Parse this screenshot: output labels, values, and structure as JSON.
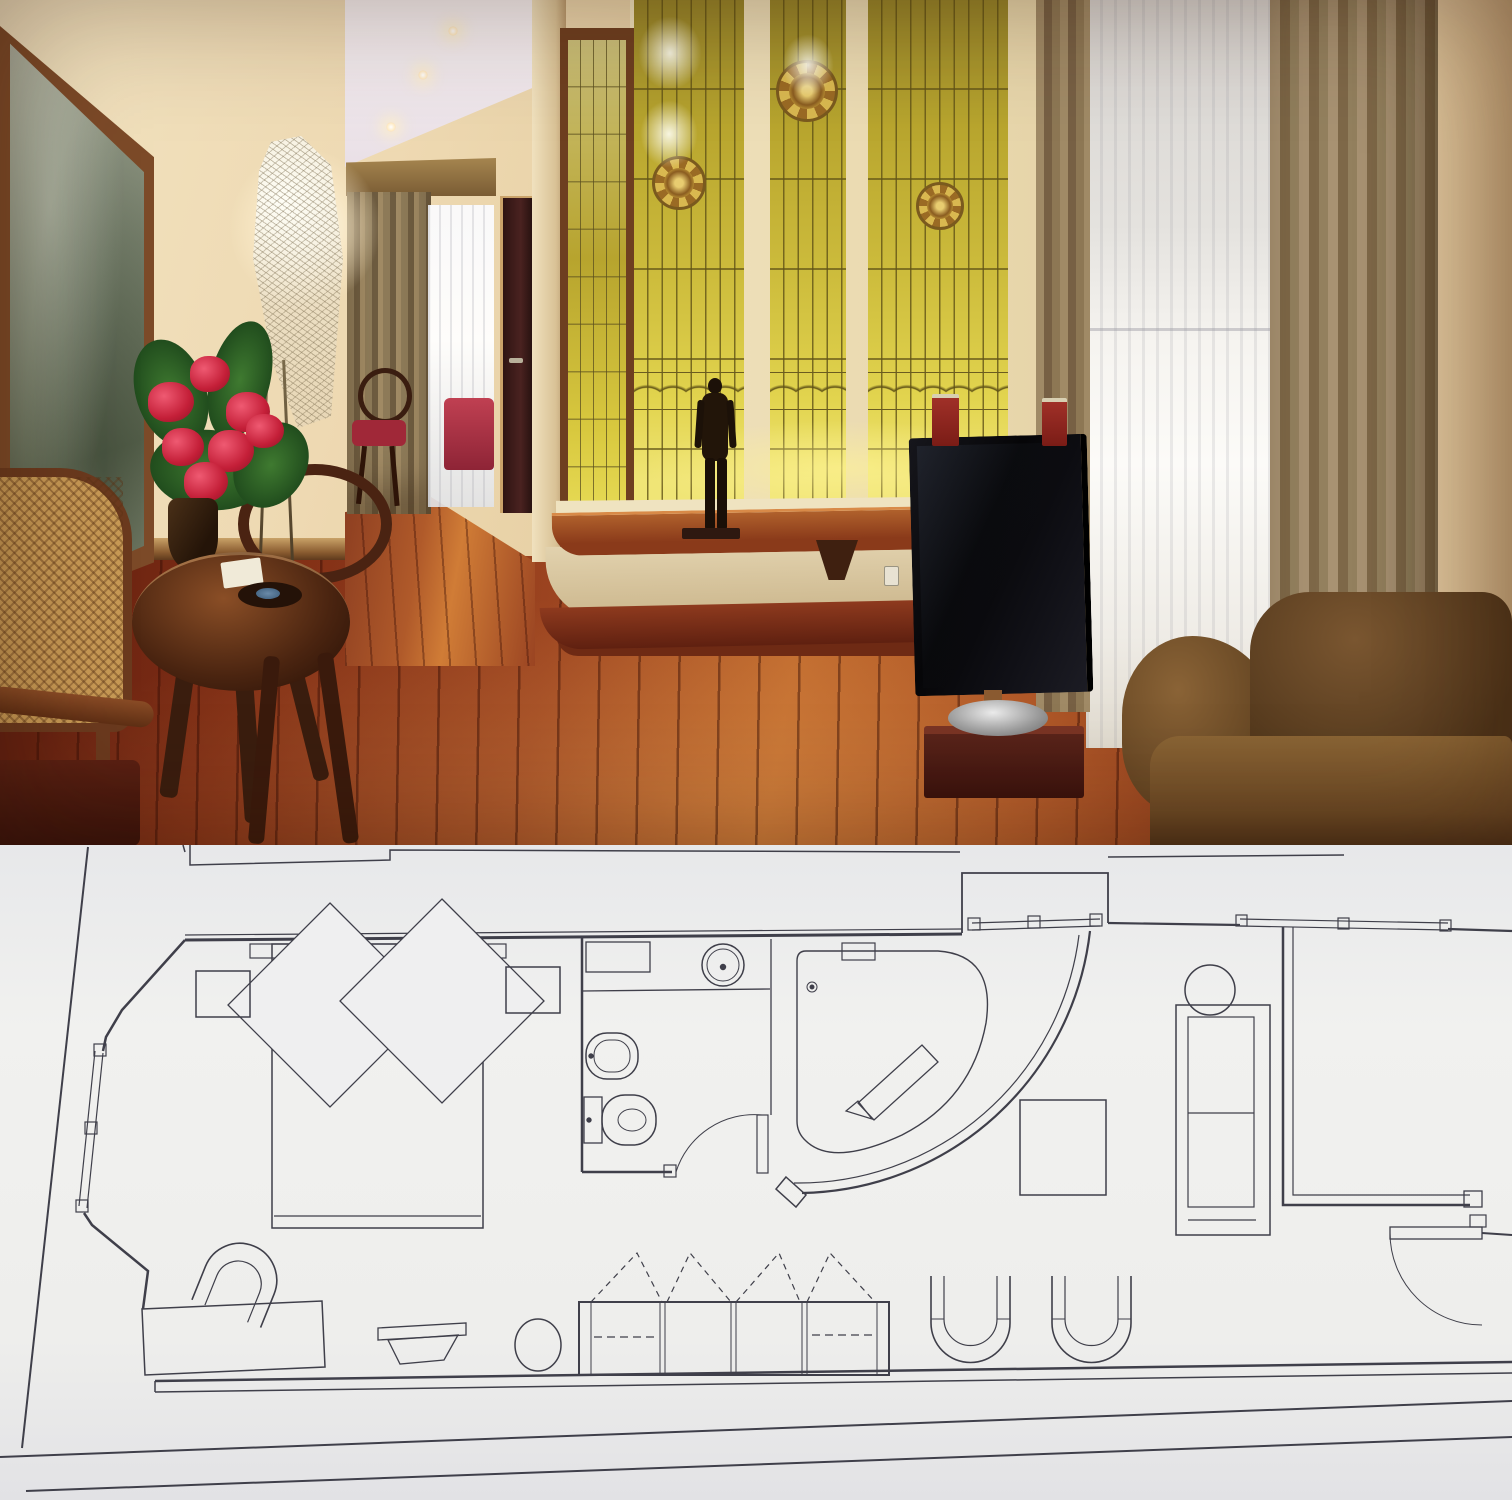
{
  "meta": {
    "subject": "hotel-suite-photo-over-floor-plan"
  },
  "palette": {
    "wall": "#eed9b2",
    "wallShade": "#d2b286",
    "ceiling": "#f7f1f2",
    "glassTop": "#97852a",
    "glassMid": "#cdbc3c",
    "glassGlow": "#f0e576",
    "lead": "#6b5c20",
    "mullion": "#f0e2bd",
    "frameWood": "#7c4a28",
    "canvas": "#79826e",
    "drape": "#8d7a58",
    "drapeRight": "#a89272",
    "sheer": "#f6f4f0",
    "doorDark": "#4a2220",
    "floorDeep": "#5f1f10",
    "floorHot": "#c06a2e",
    "hallFloor": "#b05a2a",
    "ledgeWood": "#8a3a1a",
    "ledgeFace": "#e2d2ae",
    "ledgeBase": "#8e3a1e",
    "tvBlack": "#0a0a0e",
    "tvBase": "#3a120c",
    "silver": "#9a9a9a",
    "bookRed": "#8c2220",
    "sofaBrown": "#6a4824",
    "statue": "#1c1108",
    "leaf": "#2d5a26",
    "flower": "#c41f38",
    "tableWood": "#4a2410",
    "cane": "#c89a55",
    "bedRed": "#a02838",
    "paper": "#efeff0",
    "planInk": "#3f3f4a"
  },
  "scene": {
    "objects": [
      "framed-painting",
      "mesh-floor-lamp",
      "hallway",
      "hall-curtain",
      "hall-sheer-window",
      "hall-chair",
      "hall-bed",
      "hall-door",
      "stained-glass-bay",
      "rosette-medallions",
      "bronze-statue",
      "curved-wood-ledge",
      "flat-tv",
      "tv-pedestal",
      "red-books",
      "sheer-window",
      "drapes",
      "velvet-sofa",
      "round-table",
      "flower-bouquet",
      "cane-armchair",
      "wood-armchair",
      "parquet-floor"
    ]
  },
  "floor_plan": {
    "viewBox": "0 0 1512 655",
    "bg": "#efeff0",
    "stroke": "#3f3f4a",
    "shapes": [
      {
        "t": "line",
        "n": "context-left-slant",
        "x1": 88,
        "y1": 2,
        "x2": 22,
        "y2": 603,
        "sw": 2
      },
      {
        "t": "line",
        "n": "context-top-tick",
        "x1": 183,
        "y1": 0,
        "x2": 185,
        "y2": 7,
        "sw": 1.5
      },
      {
        "t": "polyline",
        "n": "context-top-left",
        "pts": "190,0 190,20 390,15 390,5 960,7",
        "sw": 1.5
      },
      {
        "t": "polyline",
        "n": "bay-outline",
        "pts": "962,88 962,28 1108,28 1108,78",
        "sw": 1.8
      },
      {
        "t": "line",
        "n": "context-top-right",
        "x1": 1108,
        "y1": 12,
        "x2": 1344,
        "y2": 10,
        "sw": 1.5
      },
      {
        "t": "line",
        "n": "page-edge-1",
        "x1": 0,
        "y1": 612,
        "x2": 1512,
        "y2": 556,
        "sw": 2
      },
      {
        "t": "line",
        "n": "page-edge-2",
        "x1": 26,
        "y1": 646,
        "x2": 1512,
        "y2": 592,
        "sw": 2
      },
      {
        "t": "line",
        "n": "wall-top-a",
        "x1": 185,
        "y1": 90,
        "x2": 962,
        "y2": 84,
        "sw": 1.2
      },
      {
        "t": "line",
        "n": "wall-top-b",
        "x1": 185,
        "y1": 95,
        "x2": 962,
        "y2": 89,
        "sw": 3
      },
      {
        "t": "polyline",
        "n": "wall-left-upper",
        "pts": "185,95 122,165 106,192 103,206",
        "sw": 2.5
      },
      {
        "t": "line",
        "n": "window-left-a",
        "x1": 103,
        "y1": 208,
        "x2": 87,
        "y2": 363,
        "sw": 1.2
      },
      {
        "t": "line",
        "n": "window-left-b",
        "x1": 95,
        "y1": 206,
        "x2": 79,
        "y2": 361,
        "sw": 1.2
      },
      {
        "t": "rect",
        "n": "window-left-jamb-1",
        "x": 94,
        "y": 199,
        "w": 12,
        "h": 12,
        "sw": 1.2
      },
      {
        "t": "rect",
        "n": "window-left-jamb-2",
        "x": 85,
        "y": 277,
        "w": 12,
        "h": 12,
        "sw": 1.2
      },
      {
        "t": "rect",
        "n": "window-left-jamb-3",
        "x": 76,
        "y": 355,
        "w": 12,
        "h": 12,
        "sw": 1.2
      },
      {
        "t": "polyline",
        "n": "wall-left-lower",
        "pts": "84,368 92,380 148,426 143,464",
        "sw": 2.5
      },
      {
        "t": "line",
        "n": "wall-bottom-a",
        "x1": 155,
        "y1": 536,
        "x2": 1512,
        "y2": 517,
        "sw": 2.5
      },
      {
        "t": "line",
        "n": "wall-bottom-b",
        "x1": 155,
        "y1": 547,
        "x2": 1512,
        "y2": 528,
        "sw": 1.5
      },
      {
        "t": "line",
        "n": "wall-bottom-cap",
        "x1": 155,
        "y1": 536,
        "x2": 155,
        "y2": 547,
        "sw": 1.5
      },
      {
        "t": "rect",
        "n": "headboard",
        "x": 250,
        "y": 99,
        "w": 256,
        "h": 14,
        "sw": 1.2
      },
      {
        "t": "rect",
        "n": "bed",
        "x": 272,
        "y": 99,
        "w": 211,
        "h": 284,
        "sw": 1.5
      },
      {
        "t": "line",
        "n": "bed-foot-line",
        "x1": 274,
        "y1": 371,
        "x2": 481,
        "y2": 371,
        "sw": 1.2
      },
      {
        "t": "polygon",
        "n": "pillow-left",
        "pts": "330,58 432,160 330,262 228,160",
        "sw": 1.3,
        "f": "bg"
      },
      {
        "t": "polygon",
        "n": "pillow-right",
        "pts": "442,54 544,156 442,258 340,156",
        "sw": 1.3,
        "f": "bg"
      },
      {
        "t": "rect",
        "n": "nightstand-left",
        "x": 196,
        "y": 126,
        "w": 54,
        "h": 46,
        "sw": 1.5
      },
      {
        "t": "rect",
        "n": "nightstand-right",
        "x": 506,
        "y": 122,
        "w": 54,
        "h": 46,
        "sw": 1.5
      },
      {
        "t": "path",
        "n": "armchair",
        "d": "M 196,470 L 196,434 A 37 37 0 0 1 270,434 L 270,470",
        "sw": 1.6,
        "tr": "rotate(22 233 452)"
      },
      {
        "t": "path",
        "n": "armchair-inner",
        "d": "M 210,470 L 210,438 A 23 23 0 0 1 256,438 L 256,470",
        "sw": 1.2,
        "tr": "rotate(22 233 452)"
      },
      {
        "t": "polygon",
        "n": "console-table",
        "pts": "142,464 322,456 325,522 145,530",
        "sw": 1.5
      },
      {
        "t": "polygon",
        "n": "tray-lip",
        "pts": "378,483 466,478 466,490 378,495",
        "sw": 1.3
      },
      {
        "t": "polygon",
        "n": "tray-body",
        "pts": "388,495 458,490 444,515 400,519",
        "sw": 1.3
      },
      {
        "t": "ellipse",
        "n": "stool",
        "cx": 538,
        "cy": 500,
        "rx": 23,
        "ry": 26,
        "sw": 1.5
      },
      {
        "t": "line",
        "n": "bathroom-wall-left",
        "x1": 582,
        "y1": 92,
        "x2": 582,
        "y2": 327,
        "sw": 2.5
      },
      {
        "t": "line",
        "n": "bathroom-wall-bottom",
        "x1": 582,
        "y1": 327,
        "x2": 672,
        "y2": 327,
        "sw": 2.5
      },
      {
        "t": "rect",
        "n": "bath-cabinet",
        "x": 586,
        "y": 97,
        "w": 64,
        "h": 30,
        "sw": 1.3
      },
      {
        "t": "line",
        "n": "vanity-counter",
        "x1": 582,
        "y1": 146,
        "x2": 770,
        "y2": 144,
        "sw": 1.3
      },
      {
        "t": "circle",
        "n": "sink",
        "cx": 723,
        "cy": 120,
        "r": 21,
        "sw": 1.5
      },
      {
        "t": "circle",
        "n": "sink-inner",
        "cx": 723,
        "cy": 120,
        "r": 16,
        "sw": 1
      },
      {
        "t": "circle",
        "n": "sink-drain",
        "cx": 723,
        "cy": 122,
        "r": 2.5,
        "f": "ink"
      },
      {
        "t": "rect",
        "n": "bidet",
        "x": 586,
        "y": 188,
        "w": 52,
        "h": 46,
        "rx": 21,
        "sw": 1.5
      },
      {
        "t": "rect",
        "n": "bidet-inner",
        "x": 594,
        "y": 195,
        "w": 36,
        "h": 32,
        "rx": 15,
        "sw": 1
      },
      {
        "t": "circle",
        "n": "bidet-tap",
        "cx": 591,
        "cy": 211,
        "r": 2,
        "f": "ink"
      },
      {
        "t": "rect",
        "n": "toilet-tank",
        "x": 584,
        "y": 252,
        "w": 18,
        "h": 46,
        "sw": 1.3
      },
      {
        "t": "rect",
        "n": "toilet",
        "x": 602,
        "y": 250,
        "w": 54,
        "h": 50,
        "rx": 23,
        "sw": 1.5
      },
      {
        "t": "ellipse",
        "n": "toilet-seat",
        "cx": 632,
        "cy": 275,
        "rx": 14,
        "ry": 11,
        "sw": 1
      },
      {
        "t": "circle",
        "n": "toilet-tap",
        "cx": 589,
        "cy": 275,
        "r": 2,
        "f": "ink"
      },
      {
        "t": "rect",
        "n": "bath-door-jamb",
        "x": 664,
        "y": 320,
        "w": 12,
        "h": 12,
        "sw": 1.2
      },
      {
        "t": "rect",
        "n": "bath-door-leaf",
        "x": 757,
        "y": 270,
        "w": 11,
        "h": 58,
        "sw": 1.2
      },
      {
        "t": "path",
        "n": "bath-door-swing",
        "d": "M 676,327 A 82 82 0 0 1 762,270",
        "sw": 1
      },
      {
        "t": "line",
        "n": "tub-edge",
        "x1": 771,
        "y1": 94,
        "x2": 771,
        "y2": 270,
        "sw": 1.3
      },
      {
        "t": "path",
        "n": "bathtub",
        "d": "M 806,106 L 938,106 Q 996,110 986,178 Q 972,254 902,290 Q 833,322 806,296 Q 797,288 797,276 L 797,116 Q 797,106 806,106 Z",
        "sw": 1.4
      },
      {
        "t": "rect",
        "n": "tub-shelf",
        "x": 842,
        "y": 98,
        "w": 33,
        "h": 17,
        "sw": 1.2
      },
      {
        "t": "circle",
        "n": "tub-drain",
        "cx": 812,
        "cy": 142,
        "r": 5,
        "sw": 1
      },
      {
        "t": "circle",
        "n": "tub-drain-dot",
        "cx": 812,
        "cy": 142,
        "r": 1.8,
        "f": "ink"
      },
      {
        "t": "polygon",
        "n": "tub-bench",
        "pts": "858,258 922,200 938,217 874,275",
        "sw": 1.3
      },
      {
        "t": "polygon",
        "n": "tub-bench-end",
        "pts": "846,266 858,256 872,274",
        "sw": 1.2
      },
      {
        "t": "path",
        "n": "curved-wall-outer",
        "d": "M 1090,86 A 295 295 0 0 1 802,348",
        "sw": 2.2
      },
      {
        "t": "path",
        "n": "curved-wall-inner",
        "d": "M 1079,90 A 283 283 0 0 1 794,338",
        "sw": 1.2
      },
      {
        "t": "polygon",
        "n": "curved-wall-cap",
        "pts": "786,332 806,350 796,362 776,344",
        "sw": 1.5
      },
      {
        "t": "line",
        "n": "bay-window-a",
        "x1": 972,
        "y1": 78,
        "x2": 1100,
        "y2": 74,
        "sw": 1.2
      },
      {
        "t": "line",
        "n": "bay-window-b",
        "x1": 972,
        "y1": 85,
        "x2": 1100,
        "y2": 81,
        "sw": 1.2
      },
      {
        "t": "rect",
        "n": "bay-window-jamb-1",
        "x": 968,
        "y": 73,
        "w": 12,
        "h": 12,
        "sw": 1.2
      },
      {
        "t": "rect",
        "n": "bay-window-jamb-2",
        "x": 1028,
        "y": 71,
        "w": 12,
        "h": 12,
        "sw": 1.2
      },
      {
        "t": "rect",
        "n": "bay-window-jamb-3",
        "x": 1090,
        "y": 69,
        "w": 12,
        "h": 12,
        "sw": 1.2
      },
      {
        "t": "line",
        "n": "wall-top-right-a",
        "x1": 1108,
        "y1": 78,
        "x2": 1240,
        "y2": 80,
        "sw": 2.2
      },
      {
        "t": "line",
        "n": "corridor-window-a",
        "x1": 1240,
        "y1": 74,
        "x2": 1448,
        "y2": 78,
        "sw": 1.2
      },
      {
        "t": "line",
        "n": "corridor-window-b",
        "x1": 1240,
        "y1": 81,
        "x2": 1448,
        "y2": 85,
        "sw": 1.2
      },
      {
        "t": "rect",
        "n": "corridor-window-jamb-1",
        "x": 1236,
        "y": 70,
        "w": 11,
        "h": 11,
        "sw": 1.2
      },
      {
        "t": "rect",
        "n": "corridor-window-jamb-2",
        "x": 1338,
        "y": 73,
        "w": 11,
        "h": 11,
        "sw": 1.2
      },
      {
        "t": "rect",
        "n": "corridor-window-jamb-3",
        "x": 1440,
        "y": 75,
        "w": 11,
        "h": 11,
        "sw": 1.2
      },
      {
        "t": "line",
        "n": "wall-top-right-b",
        "x1": 1448,
        "y1": 84,
        "x2": 1512,
        "y2": 86,
        "sw": 2.2
      },
      {
        "t": "polyline",
        "n": "corridor-wall-outer",
        "pts": "1283,82 1283,360 1470,360",
        "sw": 2.5
      },
      {
        "t": "polyline",
        "n": "corridor-wall-inner",
        "pts": "1293,82 1293,350 1470,350",
        "sw": 1.2
      },
      {
        "t": "rect",
        "n": "entry-jamb-a",
        "x": 1464,
        "y": 346,
        "w": 18,
        "h": 16,
        "sw": 1.3
      },
      {
        "t": "rect",
        "n": "entry-jamb-b",
        "x": 1470,
        "y": 370,
        "w": 16,
        "h": 12,
        "sw": 1.2
      },
      {
        "t": "rect",
        "n": "entry-door-leaf",
        "x": 1390,
        "y": 382,
        "w": 92,
        "h": 12,
        "sw": 1.3
      },
      {
        "t": "path",
        "n": "entry-door-swing",
        "d": "M 1390,388 A 92 92 0 0 0 1482,480",
        "sw": 1
      },
      {
        "t": "line",
        "n": "entry-wall-stub",
        "x1": 1482,
        "y1": 388,
        "x2": 1512,
        "y2": 390,
        "sw": 2
      },
      {
        "t": "circle",
        "n": "side-table",
        "cx": 1210,
        "cy": 145,
        "r": 25,
        "sw": 1.5
      },
      {
        "t": "rect",
        "n": "sofa",
        "x": 1176,
        "y": 160,
        "w": 94,
        "h": 230,
        "sw": 1.5
      },
      {
        "t": "rect",
        "n": "sofa-inner",
        "x": 1188,
        "y": 172,
        "w": 66,
        "h": 190,
        "sw": 1.2
      },
      {
        "t": "line",
        "n": "sofa-cushion-line",
        "x1": 1188,
        "y1": 268,
        "x2": 1254,
        "y2": 268,
        "sw": 1.2
      },
      {
        "t": "line",
        "n": "sofa-base-line",
        "x1": 1188,
        "y1": 375,
        "x2": 1256,
        "y2": 375,
        "sw": 1.2
      },
      {
        "t": "rect",
        "n": "tv-cabinet",
        "x": 1020,
        "y": 255,
        "w": 86,
        "h": 95,
        "sw": 1.5
      },
      {
        "t": "rect",
        "n": "wardrobe",
        "x": 579,
        "y": 457,
        "w": 310,
        "h": 73,
        "sw": 2
      },
      {
        "t": "rect",
        "n": "wardrobe-cap-left",
        "x": 579,
        "y": 457,
        "w": 12,
        "h": 73,
        "sw": 1
      },
      {
        "t": "rect",
        "n": "wardrobe-cap-right",
        "x": 877,
        "y": 457,
        "w": 12,
        "h": 73,
        "sw": 1
      },
      {
        "t": "line",
        "n": "wardrobe-div-1a",
        "x1": 660,
        "y1": 457,
        "x2": 660,
        "y2": 530,
        "sw": 1
      },
      {
        "t": "line",
        "n": "wardrobe-div-1b",
        "x1": 665,
        "y1": 457,
        "x2": 665,
        "y2": 530,
        "sw": 1
      },
      {
        "t": "line",
        "n": "wardrobe-div-2a",
        "x1": 731,
        "y1": 457,
        "x2": 731,
        "y2": 530,
        "sw": 1
      },
      {
        "t": "line",
        "n": "wardrobe-div-2b",
        "x1": 736,
        "y1": 457,
        "x2": 736,
        "y2": 530,
        "sw": 1
      },
      {
        "t": "line",
        "n": "wardrobe-div-3a",
        "x1": 802,
        "y1": 457,
        "x2": 802,
        "y2": 530,
        "sw": 1
      },
      {
        "t": "line",
        "n": "wardrobe-div-3b",
        "x1": 807,
        "y1": 457,
        "x2": 807,
        "y2": 530,
        "sw": 1
      },
      {
        "t": "line",
        "n": "wardrobe-rod-1",
        "x1": 594,
        "y1": 492,
        "x2": 655,
        "y2": 492,
        "sw": 1.3,
        "dash": "8,5"
      },
      {
        "t": "line",
        "n": "wardrobe-rod-2",
        "x1": 812,
        "y1": 490,
        "x2": 872,
        "y2": 490,
        "sw": 1.3,
        "dash": "8,5"
      },
      {
        "t": "polyline",
        "n": "hanger-tri-1",
        "pts": "591,457 637,408 662,457",
        "sw": 1.2,
        "dash": "6,5"
      },
      {
        "t": "polyline",
        "n": "hanger-tri-2",
        "pts": "667,457 690,408 731,457",
        "sw": 1.2,
        "dash": "6,5"
      },
      {
        "t": "polyline",
        "n": "hanger-tri-3",
        "pts": "736,457 779,408 800,457",
        "sw": 1.2,
        "dash": "6,5"
      },
      {
        "t": "polyline",
        "n": "hanger-tri-4",
        "pts": "807,457 830,408 875,457",
        "sw": 1.2,
        "dash": "6,5"
      },
      {
        "t": "path",
        "n": "u-chair-1",
        "d": "M 931,431 L 931,478 A 39.5 39.5 0 0 0 1010,478 L 1010,431",
        "sw": 1.6
      },
      {
        "t": "path",
        "n": "u-chair-1-inner",
        "d": "M 944,431 L 944,474 A 26.5 26.5 0 0 0 997,474 L 997,431",
        "sw": 1.2
      },
      {
        "t": "line",
        "n": "u-chair-1-arm-a",
        "x1": 931,
        "y1": 474,
        "x2": 944,
        "y2": 474,
        "sw": 1
      },
      {
        "t": "line",
        "n": "u-chair-1-arm-b",
        "x1": 997,
        "y1": 474,
        "x2": 1010,
        "y2": 474,
        "sw": 1
      },
      {
        "t": "path",
        "n": "u-chair-2",
        "d": "M 1052,431 L 1052,478 A 39.5 39.5 0 0 0 1131,478 L 1131,431",
        "sw": 1.6
      },
      {
        "t": "path",
        "n": "u-chair-2-inner",
        "d": "M 1065,431 L 1065,474 A 26.5 26.5 0 0 0 1118,474 L 1118,431",
        "sw": 1.2
      },
      {
        "t": "line",
        "n": "u-chair-2-arm-a",
        "x1": 1052,
        "y1": 474,
        "x2": 1065,
        "y2": 474,
        "sw": 1
      },
      {
        "t": "line",
        "n": "u-chair-2-arm-b",
        "x1": 1118,
        "y1": 474,
        "x2": 1131,
        "y2": 474,
        "sw": 1
      }
    ]
  }
}
